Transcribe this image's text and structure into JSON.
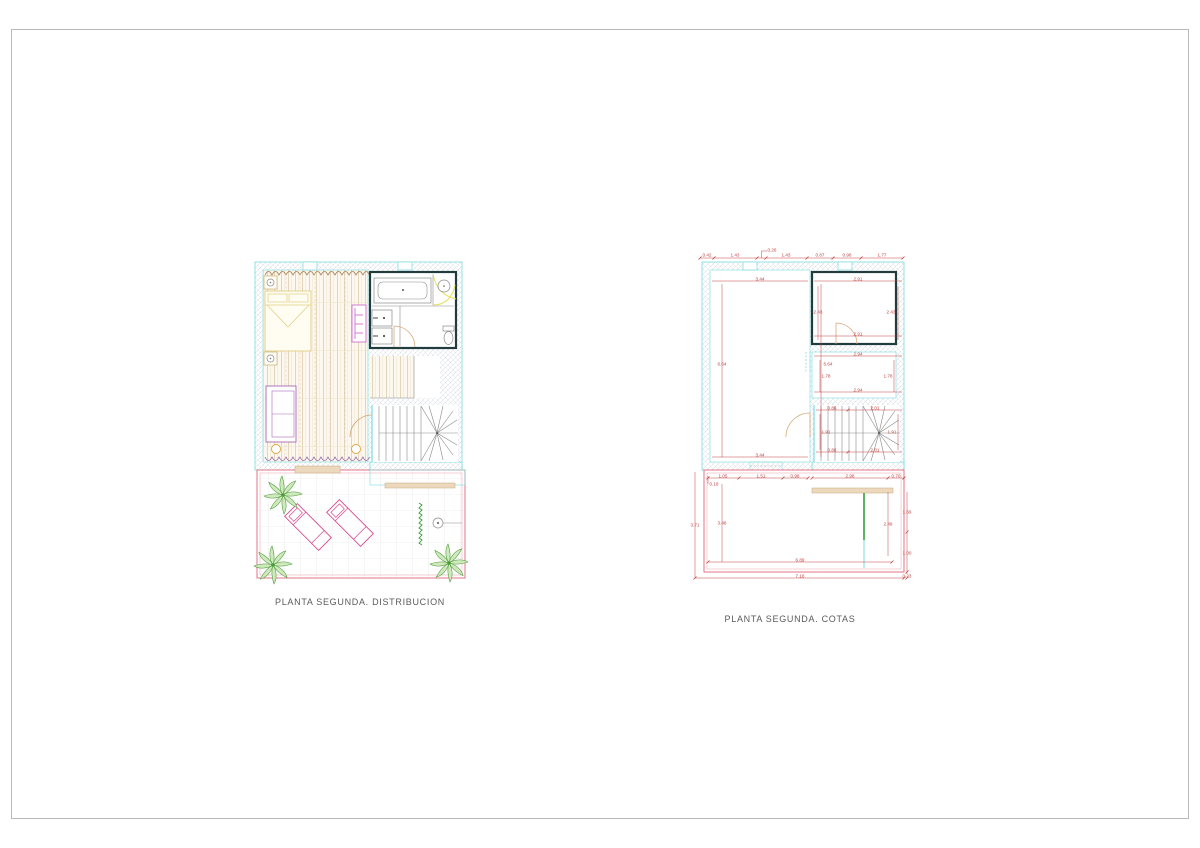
{
  "titles": {
    "left": "PLANTA SEGUNDA. DISTRIBUCION",
    "right": "PLANTA SEGUNDA. COTAS"
  },
  "colors": {
    "frame_gray": "#b8b8b8",
    "title_gray": "#5a5a5a",
    "wall_line": "#7adce0",
    "hatch": "#c9d0da",
    "dim_red": "#c04545",
    "terrace_pink": "#e06878",
    "lounger_magenta": "#d84890",
    "palm_green": "#4a9a3a",
    "hedge_green": "#3aa03a",
    "wood": "#d9c6a4",
    "bed_yellow": "#e2cc80",
    "sofa_purple": "#a868b8",
    "wardrobe_magenta": "#cf6fd0",
    "curtain_brown": "#a87850",
    "curtain_purple": "#9b62a8",
    "fixture_gray": "#8a8a8a",
    "bath_wall": "#223b3d",
    "door_tan": "#d8a878",
    "bench_tan": "#ecd9bd",
    "table_orange": "#e0a840",
    "shower_yellow": "#e8e060",
    "tile_gray": "#e4e4e4"
  },
  "cotas": {
    "dimensions": [
      {
        "t": "0.42",
        "x": 19,
        "y": 11
      },
      {
        "t": "1.43",
        "x": 47,
        "y": 11
      },
      {
        "t": "0.26",
        "x": 84,
        "y": 5.5
      },
      {
        "t": "1.43",
        "x": 98,
        "y": 11
      },
      {
        "t": "0.87",
        "x": 132,
        "y": 11
      },
      {
        "t": "0.98",
        "x": 159,
        "y": 11
      },
      {
        "t": "1.77",
        "x": 194,
        "y": 11
      },
      {
        "t": "3.44",
        "x": 72,
        "y": 34.5
      },
      {
        "t": "2.91",
        "x": 170,
        "y": 34.5
      },
      {
        "t": "2.43",
        "x": 130,
        "y": 68
      },
      {
        "t": "2.43",
        "x": 203,
        "y": 68
      },
      {
        "t": "2.91",
        "x": 170,
        "y": 89.5
      },
      {
        "t": "6.64",
        "x": 34,
        "y": 120
      },
      {
        "t": "6.64",
        "x": 140,
        "y": 120
      },
      {
        "t": "2.94",
        "x": 170,
        "y": 109.5
      },
      {
        "t": "1.78",
        "x": 138,
        "y": 132
      },
      {
        "t": "1.78",
        "x": 200,
        "y": 132
      },
      {
        "t": "2.94",
        "x": 170,
        "y": 145.5
      },
      {
        "t": "0.86",
        "x": 144,
        "y": 163.5
      },
      {
        "t": "2.01",
        "x": 187,
        "y": 163.5
      },
      {
        "t": "1.91",
        "x": 138,
        "y": 188
      },
      {
        "t": "1.91",
        "x": 204,
        "y": 188
      },
      {
        "t": "0.86",
        "x": 144,
        "y": 205.5
      },
      {
        "t": "2.01",
        "x": 187,
        "y": 205.5
      },
      {
        "t": "3.44",
        "x": 72,
        "y": 210.5
      },
      {
        "t": "1.05",
        "x": 35,
        "y": 231.5
      },
      {
        "t": "1.51",
        "x": 73,
        "y": 231.5
      },
      {
        "t": "0.98",
        "x": 107,
        "y": 231.5
      },
      {
        "t": "2.98",
        "x": 162,
        "y": 231.5
      },
      {
        "t": "0.70",
        "x": 208,
        "y": 231.5
      },
      {
        "t": "0.18",
        "x": 26,
        "y": 240
      },
      {
        "t": "3.71",
        "x": 7,
        "y": 281
      },
      {
        "t": "3.48",
        "x": 34,
        "y": 279
      },
      {
        "t": "2.49",
        "x": 200,
        "y": 280
      },
      {
        "t": "1.69",
        "x": 219,
        "y": 268
      },
      {
        "t": "1.00",
        "x": 219,
        "y": 309
      },
      {
        "t": "0.23",
        "x": 219,
        "y": 332
      },
      {
        "t": "6.89",
        "x": 112,
        "y": 315.5
      },
      {
        "t": "7.16",
        "x": 112,
        "y": 331.5
      }
    ]
  }
}
